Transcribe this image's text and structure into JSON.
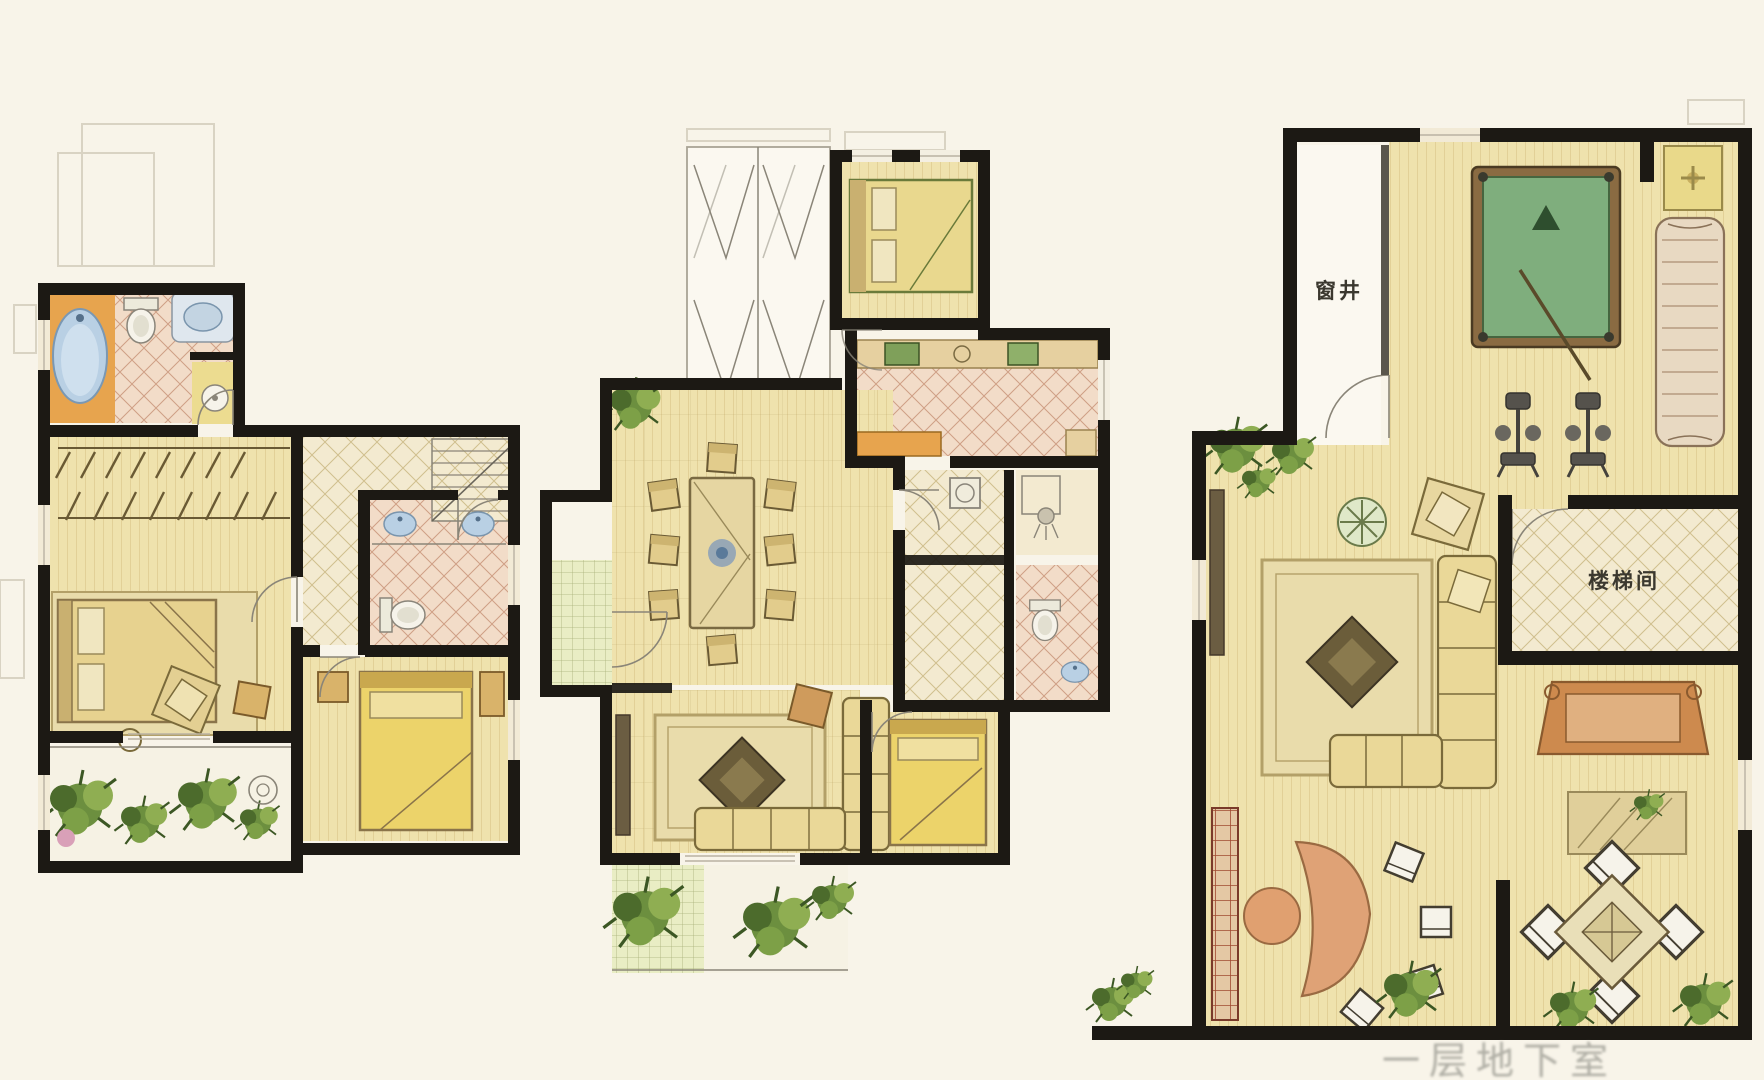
{
  "labels": {
    "window_well": "窗井",
    "stairwell": "楼梯间",
    "caption_partial": "一层地下室"
  },
  "colors": {
    "bg": "#f8f4e9",
    "wall": "#1c1914",
    "floor": "#efe2ad",
    "floorLine": "#d8c488",
    "tilePink": "#f2dcc8",
    "tilePinkLine": "#cf9f85",
    "tilePale": "#f3ead0",
    "tilePaleLine": "#d0bf8e",
    "orange": "#e7a44e",
    "billiardGreen": "#7fae7d",
    "billiardGreenDark": "#46653f",
    "entryGrid": "#e9edc4",
    "entryGridLine": "#a8b078",
    "plantGreen": "#6c8f3f",
    "bedTan": "#e7d28f",
    "sofaTan": "#ead898",
    "wood": "#c8884f",
    "rug": "#e9dcab",
    "rugLine": "#b3a068",
    "fixtureWhite": "#f6f3ea",
    "waterBlue": "#b9d0e4",
    "gray": "#8a8578",
    "label": "#3b382f",
    "caption": "#a8a79e"
  },
  "panels": [
    {
      "id": "left-unit",
      "furniture": [
        "bathtub",
        "toilet",
        "vanity-sink",
        "wash-basin",
        "closet-hanger-rail",
        "double-bed",
        "bedroom-rug",
        "armchair",
        "side-table",
        "floor-lamp",
        "staircase",
        "twin-sinks",
        "second-toilet",
        "single-bed",
        "nightstands",
        "balcony-plants",
        "flower-pot"
      ]
    },
    {
      "id": "middle-unit",
      "furniture": [
        "folding-balcony-doors",
        "double-bed",
        "kitchen-counter",
        "stove-appliance",
        "kitchen-sink",
        "fridge",
        "dining-table",
        "dining-chairs-x8",
        "entry-vestibule-door",
        "potted-plant",
        "washing-machine",
        "shower-head",
        "toilet",
        "wash-basin",
        "tv-cabinet",
        "living-rug",
        "coffee-table",
        "corner-sofa",
        "side-table",
        "single-bed",
        "balcony-plants"
      ]
    },
    {
      "id": "basement-unit",
      "furniture": [
        "billiard-table",
        "cue-stick",
        "triangle-rack",
        "lounge-sofa",
        "corner-flower-table",
        "exercise-machine-x2",
        "tv-console",
        "armchair",
        "round-plant-table",
        "sectional-sofa",
        "living-rug",
        "coffee-table",
        "bookshelf",
        "reception-desk",
        "desk-stool",
        "desk-chairs-x4",
        "console-desk",
        "small-rug",
        "square-dining-table",
        "dining-chairs-x4",
        "plants"
      ]
    }
  ]
}
